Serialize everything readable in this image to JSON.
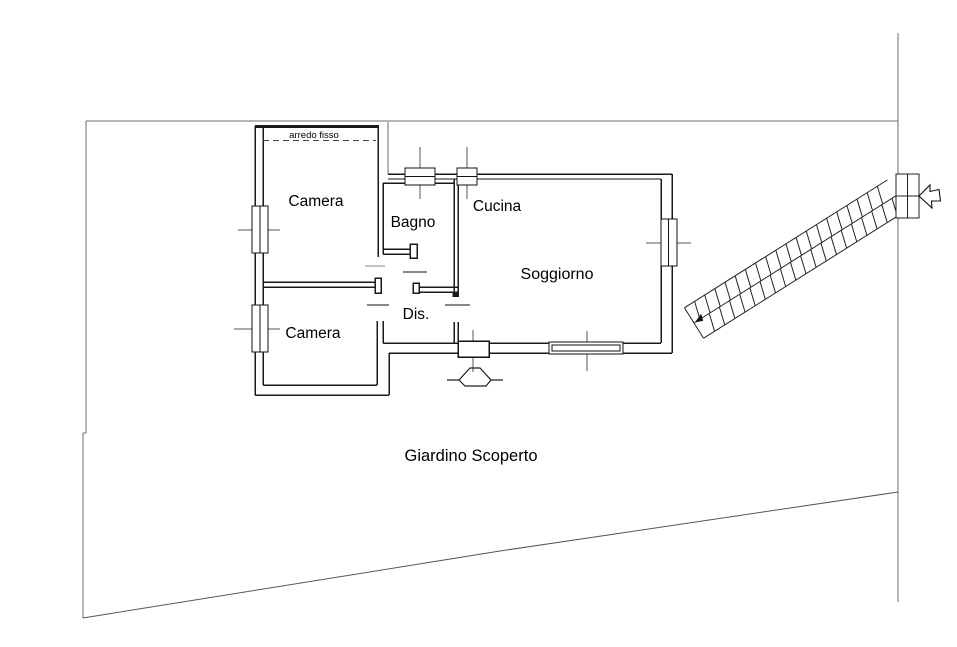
{
  "plan": {
    "title": "floor-plan",
    "rooms": [
      {
        "id": "camera-1",
        "label": "Camera"
      },
      {
        "id": "bagno",
        "label": "Bagno"
      },
      {
        "id": "cucina",
        "label": "Cucina"
      },
      {
        "id": "soggiorno",
        "label": "Soggiorno"
      },
      {
        "id": "camera-2",
        "label": "Camera"
      },
      {
        "id": "disimpegno",
        "label": "Dis."
      }
    ],
    "garden_label": "Giardino Scoperto",
    "fixed_furniture_label": "arredo fisso",
    "colors": {
      "background": "#ffffff",
      "wall": "#1a1a1a",
      "boundary": "#6e6e6e",
      "axis_line": "#555555"
    }
  }
}
